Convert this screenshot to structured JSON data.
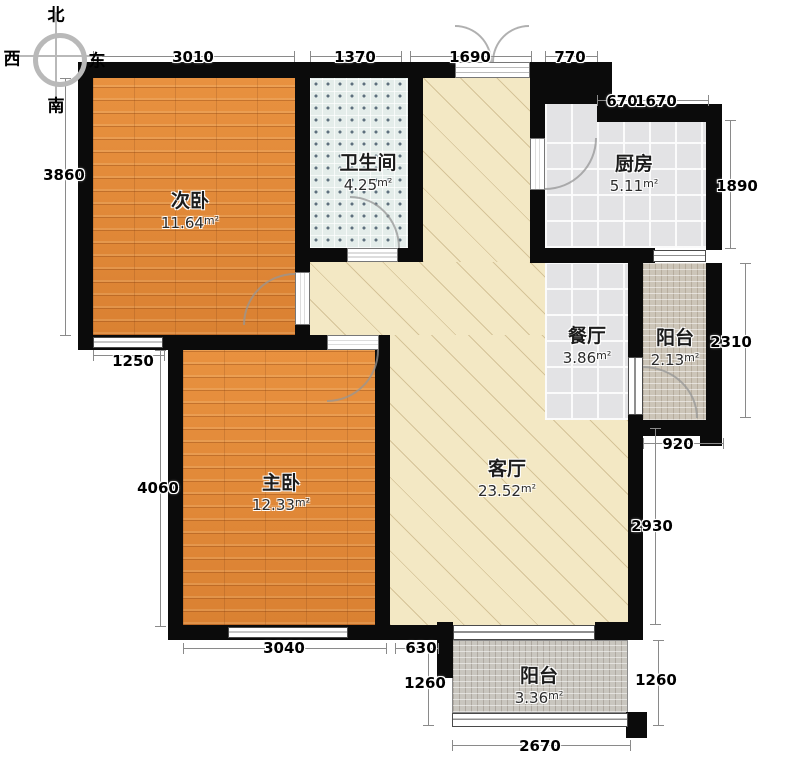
{
  "title": "两室两厅户型平面图",
  "compass": {
    "north": "北",
    "west": "西",
    "south": "南",
    "east": "东"
  },
  "rooms": [
    {
      "id": "secondary-bedroom",
      "name": "次卧",
      "area": "11.64",
      "unit": "m²"
    },
    {
      "id": "bathroom",
      "name": "卫生间",
      "area": "4.25",
      "unit": "m²"
    },
    {
      "id": "kitchen",
      "name": "厨房",
      "area": "5.11",
      "unit": "m²"
    },
    {
      "id": "dining-room",
      "name": "餐厅",
      "area": "3.86",
      "unit": "m²"
    },
    {
      "id": "balcony-east",
      "name": "阳台",
      "area": "2.13",
      "unit": "m²"
    },
    {
      "id": "master-bedroom",
      "name": "主卧",
      "area": "12.33",
      "unit": "m²"
    },
    {
      "id": "living-room",
      "name": "客厅",
      "area": "23.52",
      "unit": "m²"
    },
    {
      "id": "balcony-south",
      "name": "阳台",
      "area": "3.36",
      "unit": "m²"
    }
  ],
  "dimensions": {
    "top": [
      "3010",
      "1370",
      "1690",
      "770"
    ],
    "inner_top": [
      "670",
      "1670"
    ],
    "left": [
      "3860",
      "1250",
      "4060"
    ],
    "right": [
      "1890",
      "2310",
      "920",
      "2930",
      "1260"
    ],
    "bottom": [
      "3040",
      "630",
      "1260",
      "2670"
    ]
  },
  "colors": {
    "wall": "#0b0b0b",
    "wood_floor": "#e0873a",
    "living_floor": "#f3e8c4",
    "tile_floor": "#e3e3e5",
    "mosaic_floor": "#ccc5b8",
    "dimension_line": "#8a8a8a"
  }
}
